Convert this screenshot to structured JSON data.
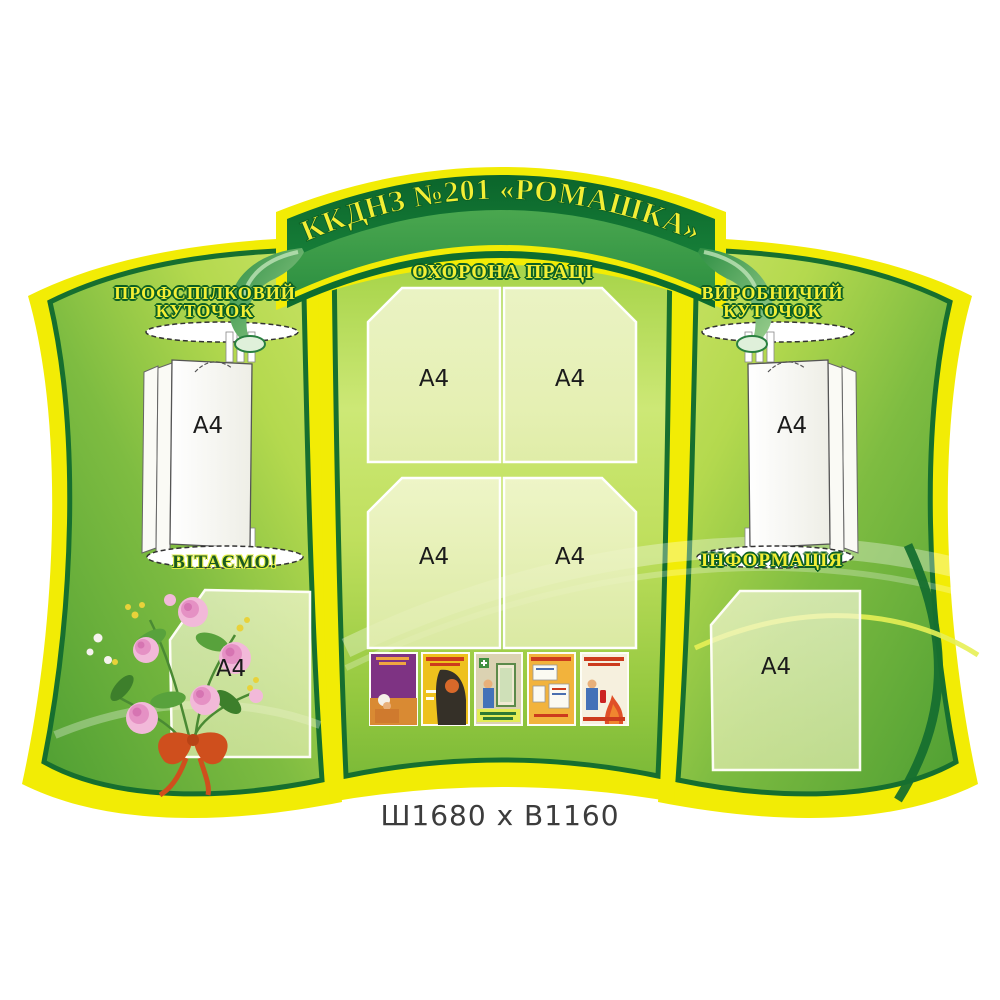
{
  "banner": {
    "title": "ККДНЗ №201 «РОМАШКА»"
  },
  "panels": {
    "left": {
      "title_line1": "ПРОФСПІЛКОВИЙ",
      "title_line2": "КУТОЧОК",
      "holder_label": "A4",
      "section2_title": "ВІТАЄМО!",
      "pocket_label": "A4"
    },
    "center": {
      "title": "ОХОРОНА ПРАЦІ",
      "pocket_labels": [
        "A4",
        "A4",
        "A4",
        "A4"
      ],
      "posters": [
        {
          "name": "worker-head-protection-poster",
          "colors": [
            "#7e3383",
            "#d98a33"
          ]
        },
        {
          "name": "welding-safety-poster",
          "colors": [
            "#eec11d",
            "#353028"
          ]
        },
        {
          "name": "first-aid-room-poster",
          "colors": [
            "#dbd2b2",
            "#5c8a4a"
          ]
        },
        {
          "name": "info-boards-poster",
          "colors": [
            "#f2b33c",
            "#fbfaf2"
          ]
        },
        {
          "name": "fire-extinguisher-poster",
          "colors": [
            "#f6f0de",
            "#e05028"
          ]
        }
      ]
    },
    "right": {
      "title_line1": "ВИРОБНИЧИЙ",
      "title_line2": "КУТОЧОК",
      "holder_label": "A4",
      "section2_title": "ІНФОРМАЦІЯ",
      "pocket_label": "A4"
    }
  },
  "caption": {
    "dimensions": "Ш1680 х В1160"
  },
  "colors": {
    "outer_yellow": "#f2ec05",
    "border_dark_green": "#166f2f",
    "banner_dark_green": "#0d6d2f",
    "banner_green": "#3fa04c",
    "panel_light_green": "#c4e060",
    "panel_green": "#4f9f33",
    "title_yellow": "#f3ee35",
    "pocket_fill": "#eef3c4"
  }
}
